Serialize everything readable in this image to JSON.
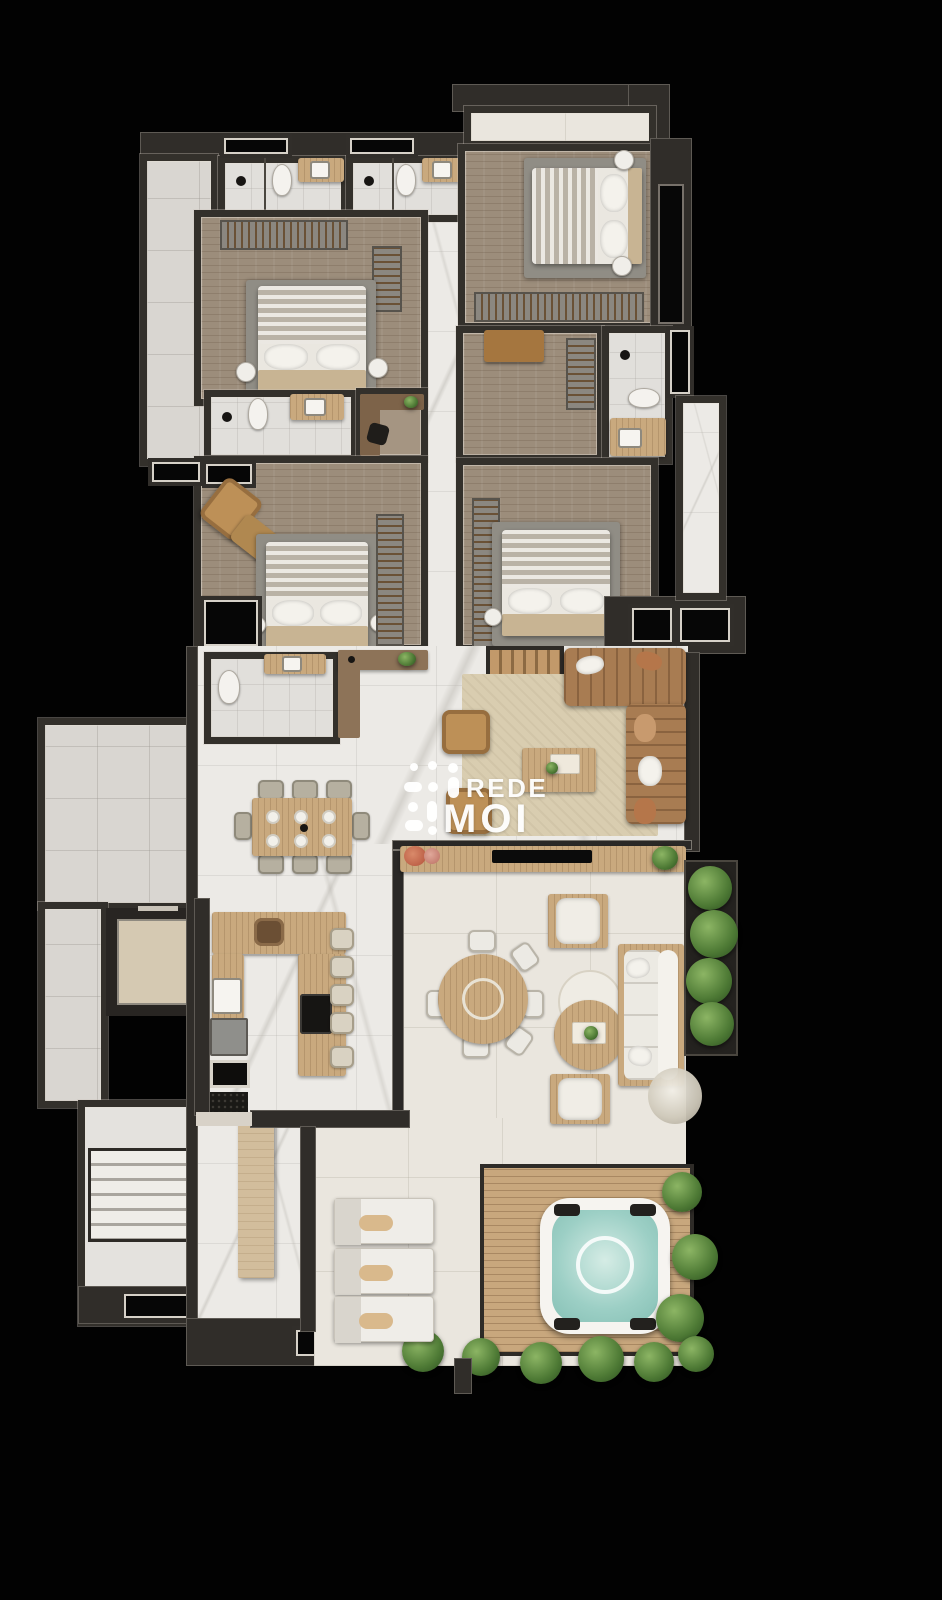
{
  "image_type": "architectural-floor-plan-render",
  "watermark": {
    "line1": "REDE",
    "line2": "MOI"
  },
  "palette": {
    "background": "#020202",
    "walls": "#302d29",
    "marble_floor": "#eceae6",
    "wood_floor": "#9c8d7b",
    "gray_tile": "#d9d6d1",
    "terrace_tile": "#eae6de",
    "deck_wood": "#c8a77d",
    "sofa_brown": "#a87c52",
    "hot_tub_water": "#9ccfc5",
    "plant_green": "#4e7a35",
    "watermark_color": "#ffffff"
  },
  "canvas": {
    "width": 942,
    "height": 1600
  }
}
